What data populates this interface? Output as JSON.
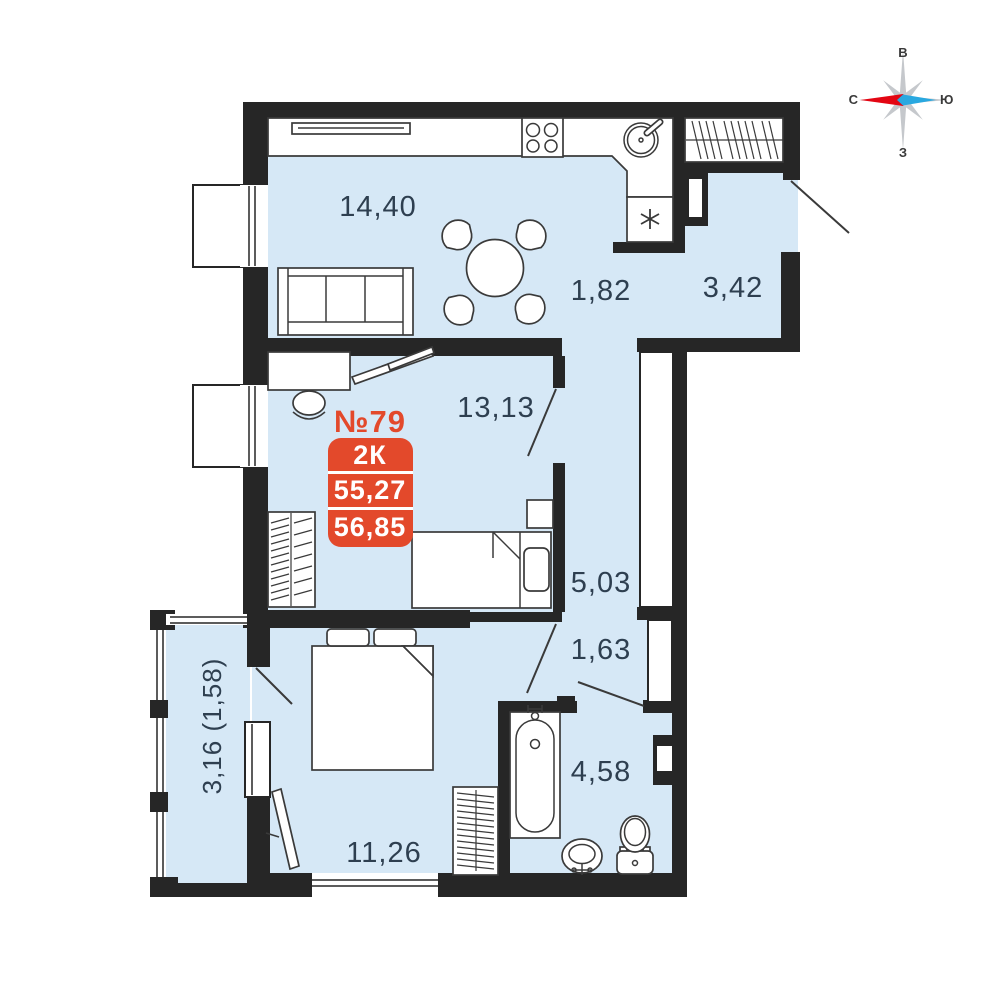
{
  "badge": {
    "number": "№79",
    "type": "2К",
    "area1": "55,27",
    "area2": "56,85"
  },
  "rooms": {
    "kitchen_living": "14,40",
    "hall_segment": "1,82",
    "entry_hall": "3,42",
    "room": "13,13",
    "corridor": "5,03",
    "corridor2": "1,63",
    "bathroom": "4,58",
    "bedroom": "11,26",
    "balcony": "3,16 (1,58)"
  },
  "compass": {
    "top": "В",
    "right": "Ю",
    "bottom": "З",
    "left": "С"
  },
  "colors": {
    "wall": "#262626",
    "floor": "#D6E8F6",
    "accent": "#E3492B",
    "label": "#2E3F50",
    "compass_red": "#E30613",
    "compass_blue": "#29A8E0",
    "compass_gray": "#C5C8CC"
  }
}
